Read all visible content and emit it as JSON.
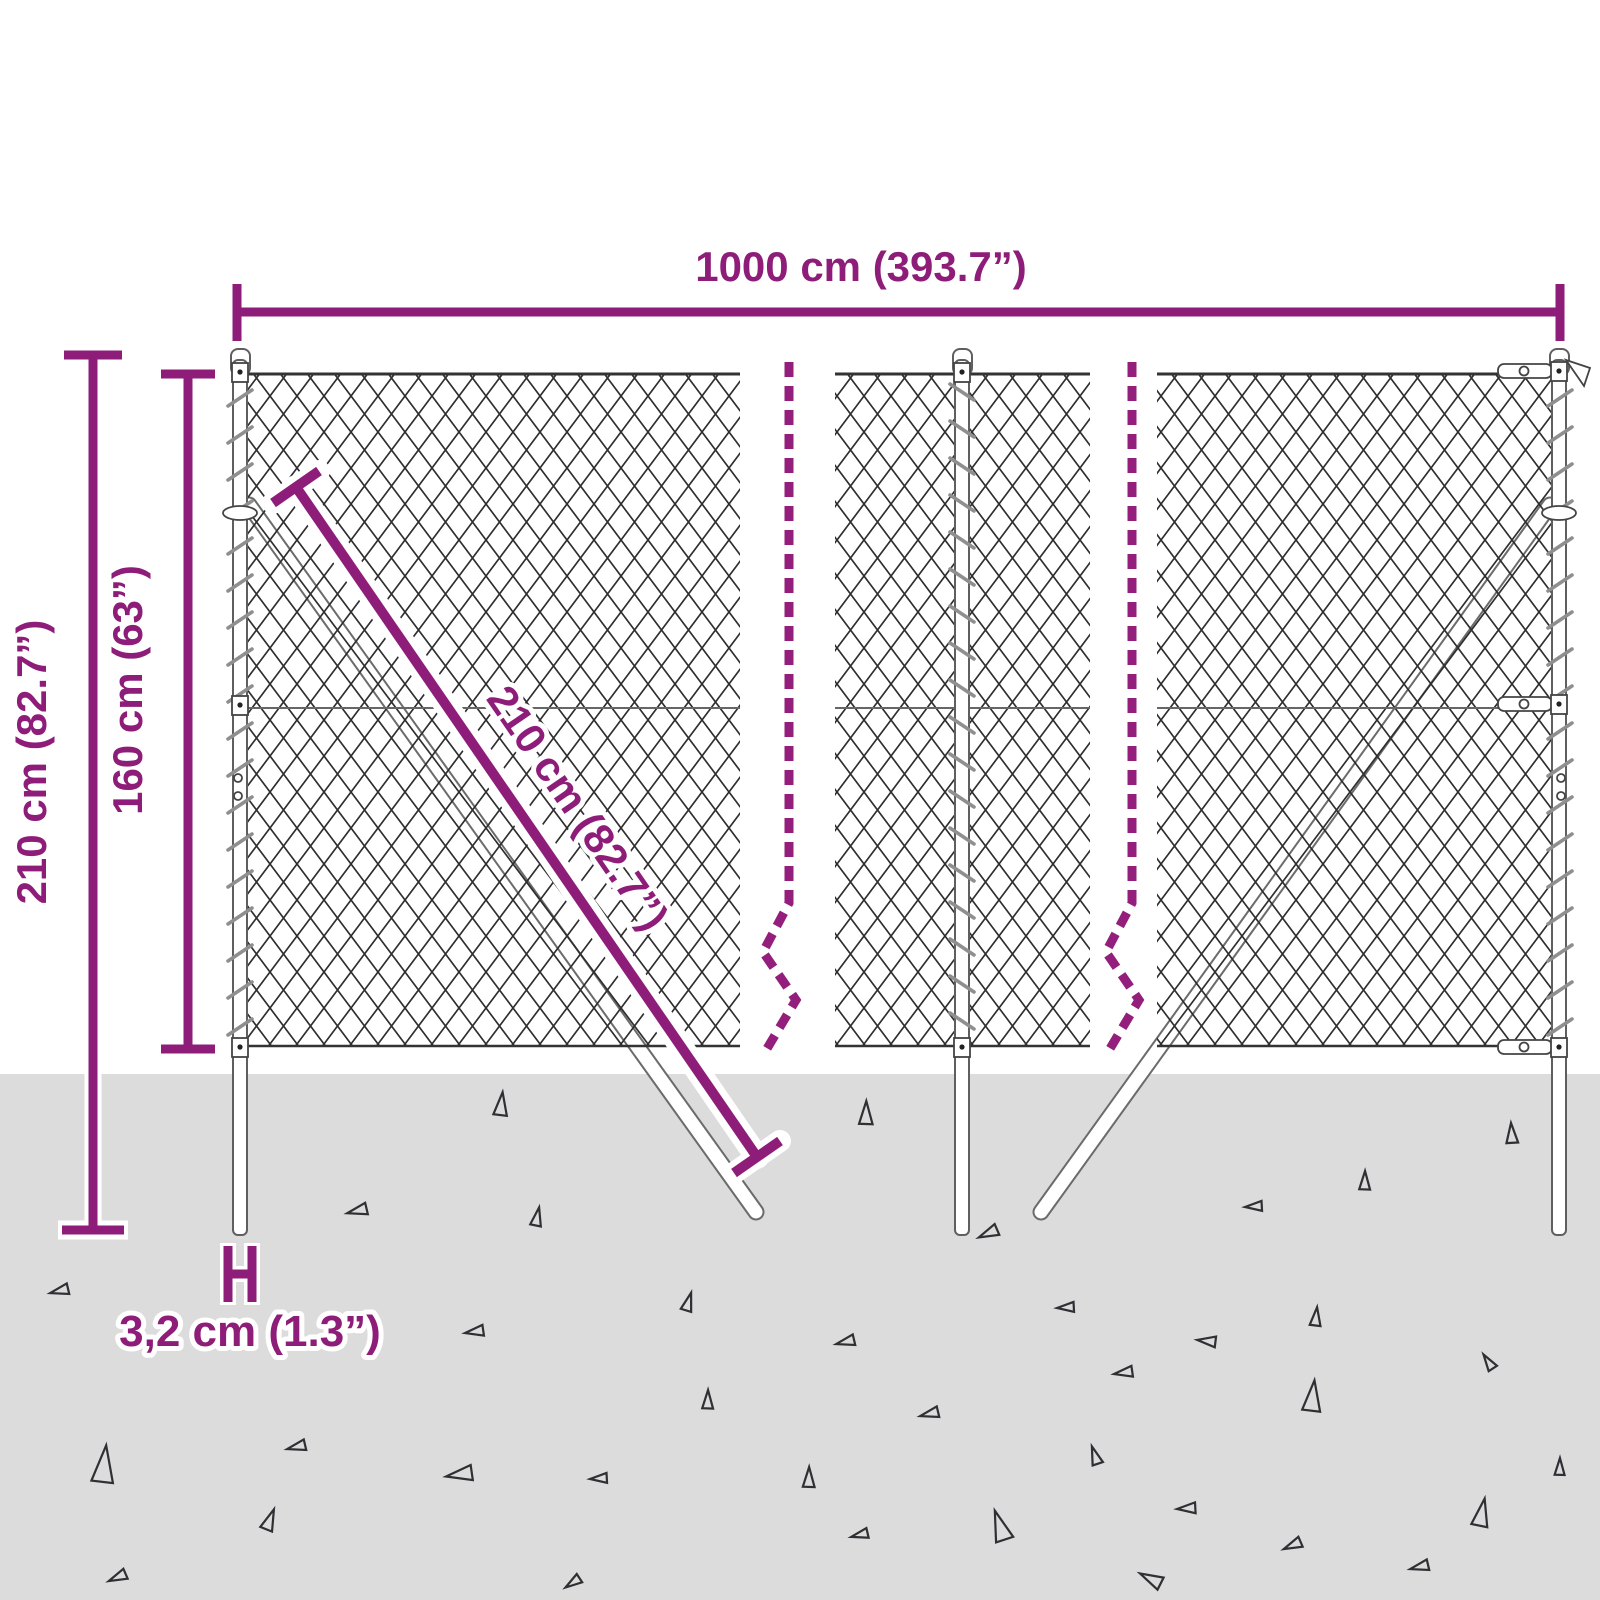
{
  "diagram": {
    "colors": {
      "accent": "#8e1d79",
      "ground": "#dcdcdc",
      "mesh_line": "#2e2e2e"
    },
    "dimensions": {
      "total_width": "1000 cm (393.7”)",
      "total_height": "210 cm (82.7”)",
      "mesh_height": "160 cm (63”)",
      "post_length": "210 cm (82.7”)",
      "post_diameter": "3,2 cm (1.3”)"
    }
  }
}
